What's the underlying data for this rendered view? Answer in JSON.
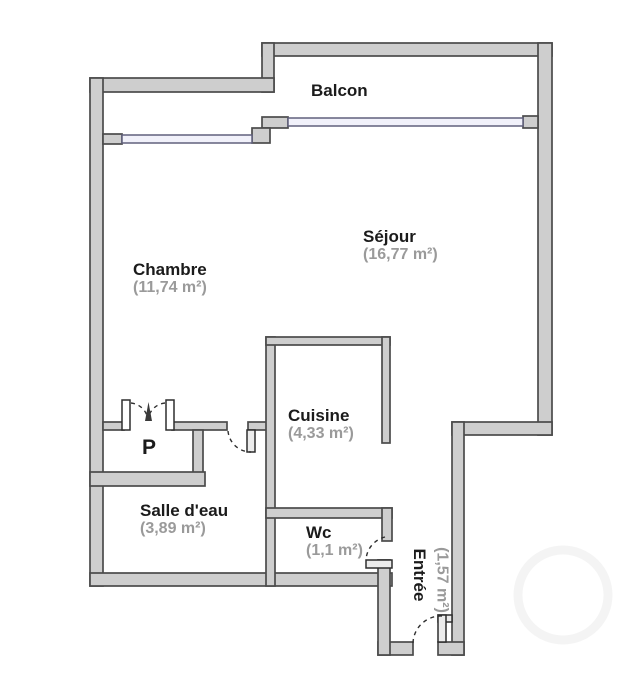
{
  "plan": {
    "rooms": {
      "balcon": {
        "name": "Balcon"
      },
      "chambre": {
        "name": "Chambre",
        "area": "(11,74 m²)"
      },
      "sejour": {
        "name": "Séjour",
        "area": "(16,77 m²)"
      },
      "cuisine": {
        "name": "Cuisine",
        "area": "(4,33 m²)"
      },
      "placard": {
        "name": "P"
      },
      "salle_deau": {
        "name": "Salle d'eau",
        "area": "(3,89 m²)"
      },
      "wc": {
        "name": "Wc",
        "area": "(1,1 m²)"
      },
      "entree": {
        "name": "Entrée",
        "area": "(1,57 m²)"
      }
    },
    "colors": {
      "background": "#ffffff",
      "wall_fill": "#cecece",
      "wall_stroke": "#4b4b4b",
      "window_fill": "#f1f1fa",
      "window_stroke": "#61617d",
      "room_name_color": "#1b1b1b",
      "area_color": "#9a9a9a"
    }
  }
}
